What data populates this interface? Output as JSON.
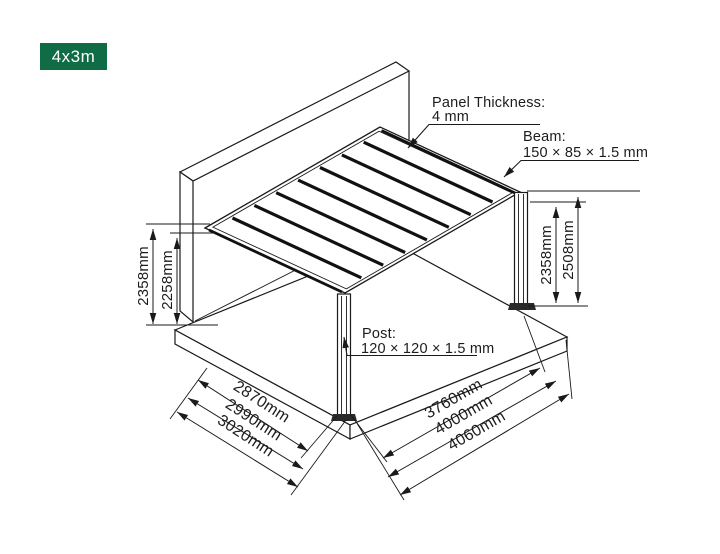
{
  "badge": {
    "label": "4x3m",
    "color": "#0F6C45"
  },
  "annotations": {
    "panel_thickness": {
      "title": "Panel Thickness:",
      "value": "4 mm"
    },
    "beam": {
      "title": "Beam:",
      "value": "150 × 85 × 1.5 mm"
    },
    "post": {
      "title": "Post:",
      "value": "120 × 120 × 1.5 mm"
    }
  },
  "dimensions": {
    "left_height": {
      "outer": "2358mm",
      "inner": "2258mm"
    },
    "right_height": {
      "inner": "2358mm",
      "outer": "2508mm"
    },
    "bottom_left": [
      "2870mm",
      "2990mm",
      "3020mm"
    ],
    "bottom_right": [
      "3760mm",
      "4000mm",
      "4060mm"
    ]
  },
  "drawing": {
    "line_color": "#1a1a1a"
  }
}
